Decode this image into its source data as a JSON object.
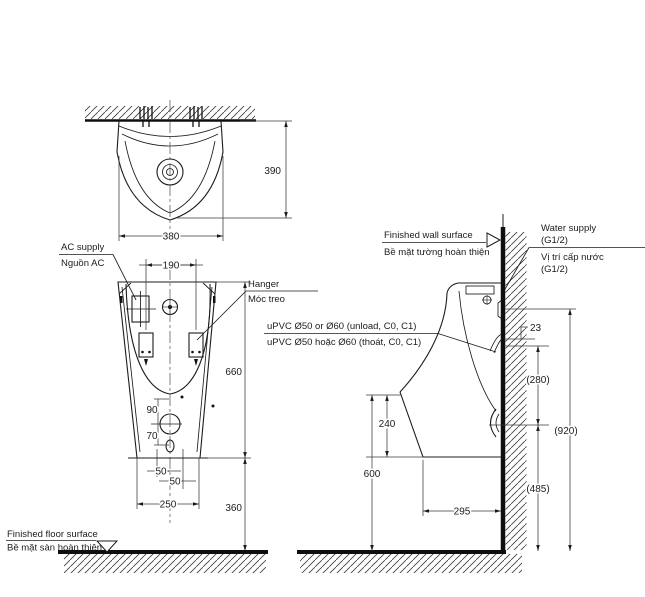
{
  "drawing": {
    "labels": {
      "ac_supply_en": "AC supply",
      "ac_supply_vi": "Nguồn AC",
      "hanger_en": "Hanger",
      "hanger_vi": "Móc treo",
      "floor_en": "Finished floor surface",
      "floor_vi": "Bề mặt sàn hoàn thiện",
      "wall_en": "Finished wall surface",
      "wall_vi": "Bề mặt tường hoàn thiện",
      "water_en_1": "Water supply",
      "water_en_2": "(G1/2)",
      "water_vi_1": "Vị trí cấp nước",
      "water_vi_2": "(G1/2)",
      "upvc_en": "uPVC Ø50 or Ø60 (unload, C0, C1)",
      "upvc_vi": "uPVC Ø50 hoặc Ø60 (thoát, C0, C1)"
    },
    "dimensions": {
      "plan_width": "380",
      "plan_depth": "390",
      "hanger_spacing": "190",
      "body_height": "660",
      "drain_offset_up": "90",
      "drain_offset_down": "70",
      "bolt_left": "50",
      "bolt_right": "50",
      "bottom_width": "250",
      "floor_clearance": "360",
      "supply_offset": "23",
      "supply_to_trap": "(280)",
      "supply_height": "(920)",
      "trap_height": "(485)",
      "lip_drop": "240",
      "lip_height": "600",
      "trap_depth": "295"
    },
    "colors": {
      "line": "#1c1c1c",
      "dim": "#3a3a3a",
      "bg": "#ffffff"
    }
  }
}
